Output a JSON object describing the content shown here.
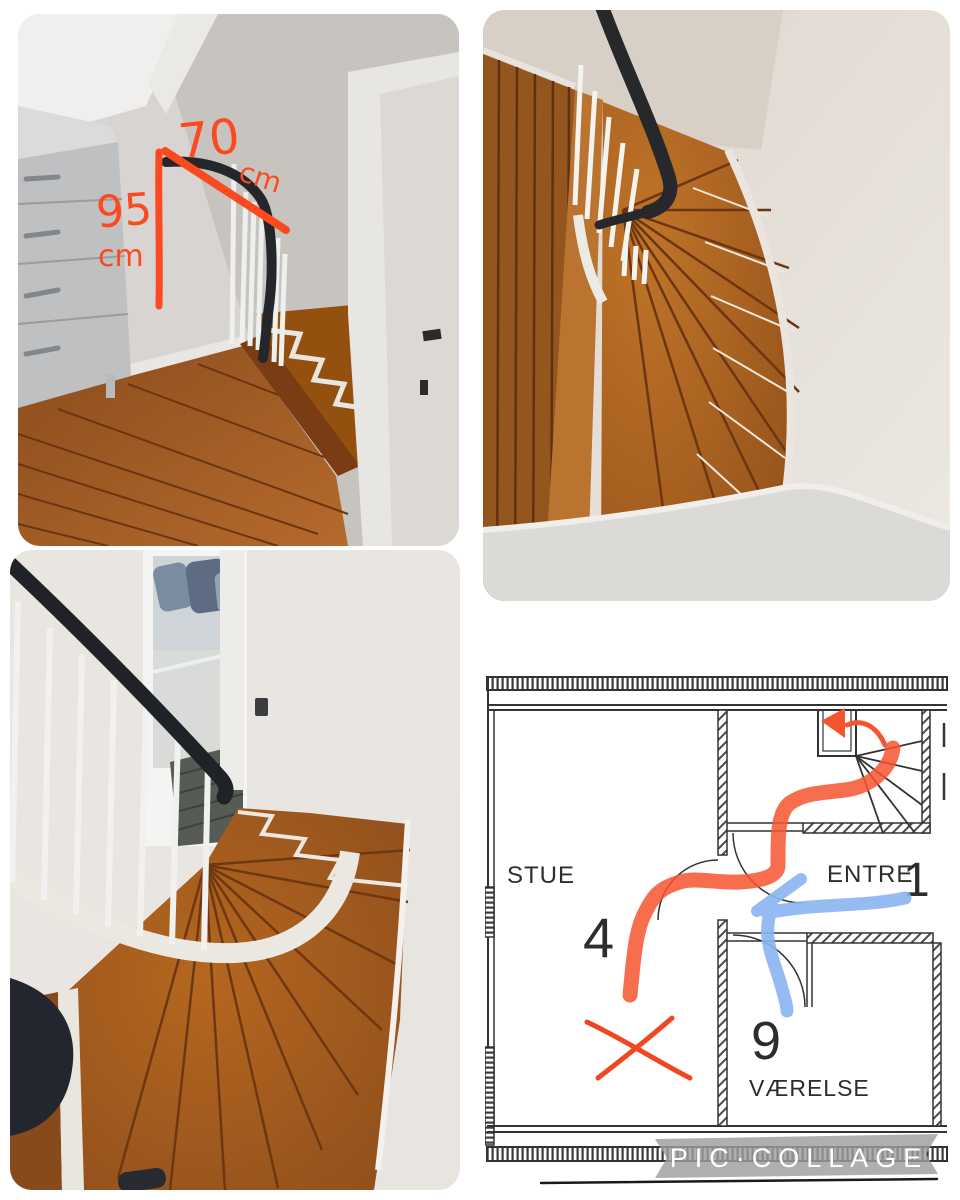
{
  "watermark": {
    "text": "PIC·COLLAGE",
    "band_color": "#9e9e9e",
    "text_color": "#ffffff"
  },
  "annotations": {
    "width": {
      "value": "70",
      "unit": "cm"
    },
    "height": {
      "value": "95",
      "unit": "cm"
    },
    "marker_color": "#fb4a1f"
  },
  "floor_plan": {
    "living_room_label": "STUE",
    "living_room_number": "4",
    "hall_label": "ENTRE",
    "hall_number": "1",
    "bedroom_number": "9",
    "bedroom_label": "VÆRELSE",
    "route_red": "#f4552f",
    "route_blue": "#8ab5f1",
    "x_mark_color": "#ef4721",
    "line_color": "#333333"
  },
  "photo_colors": {
    "wood_dark": "#8a4a1c",
    "wood_light": "#b56a2c",
    "wall_grey": "#cfccc8",
    "handrail_black": "#24262a"
  }
}
